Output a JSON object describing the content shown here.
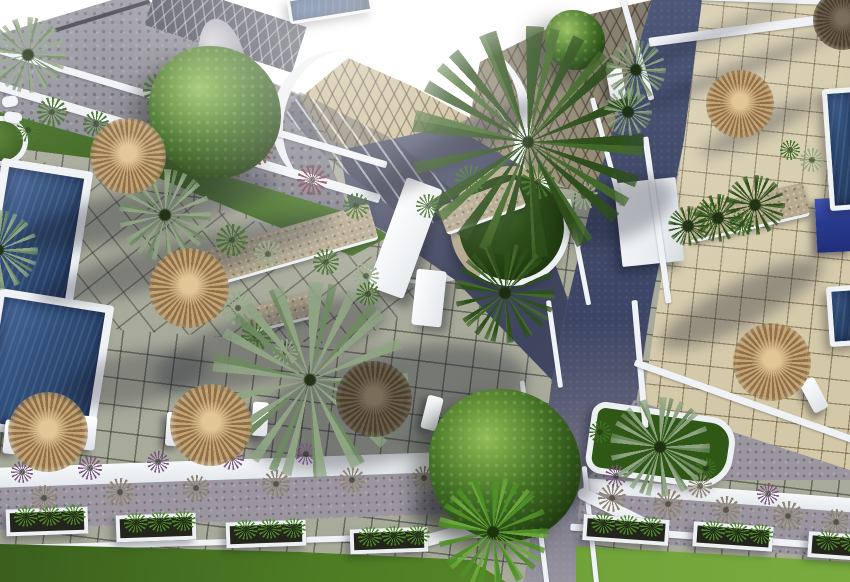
{
  "scene": {
    "description": "Aerial 3D architectural rendering of a resort courtyard: swimming pools and grey tiled terrace on the left, beige tiled terrace on the right, curved white walls and roofs at top, a navy pathway curving through the middle with a circular palm planter, thatched straw parasols with white sun loungers, landscaped beds, and a street with white-framed planters and lawns at the bottom",
    "palette": {
      "wall": "#f0f3f6",
      "tileL": "#a8aa9a",
      "groutL": "#62655c",
      "tileR": "#d3c8a7",
      "groutR": "#8b7a55",
      "road": "#434c6b",
      "cobble": "#75737f",
      "gravel": "#9b96a0",
      "lawnL": "#4e7c24",
      "lawnR": "#74a53c",
      "bedGreen": "#4a7423",
      "bedDark": "#2f5716",
      "water1": "#47689a",
      "water2": "#223a5e",
      "cube": "#2e3f96",
      "straw1": "#c6a471",
      "straw2": "#8d6f4a",
      "strawHi": "#e2c796",
      "canopy": "#3f6d2b",
      "silverPalm": "#8ea483",
      "brightPalm": "#5f9c2f",
      "stone": "#b4a88d",
      "tanRoof": "#c9b88e",
      "shadow": "#181b2a"
    },
    "pools": [
      {
        "x": -10,
        "y": 164,
        "w": 92,
        "h": 152,
        "rot": 9,
        "b": 8
      },
      {
        "x": -14,
        "y": 296,
        "w": 118,
        "h": 142,
        "rot": 9,
        "b": 8
      },
      {
        "x": 826,
        "y": 88,
        "w": 34,
        "h": 122,
        "rot": -4,
        "b": 5
      },
      {
        "x": 828,
        "y": 286,
        "w": 30,
        "h": 60,
        "rot": -4,
        "b": 5
      },
      {
        "x": 288,
        "y": -8,
        "w": 84,
        "h": 26,
        "rot": -9,
        "b": 3
      }
    ],
    "umbrellas": [
      {
        "x": 128,
        "y": 156,
        "r": 38,
        "tone": "light"
      },
      {
        "x": 189,
        "y": 288,
        "r": 40,
        "tone": "light"
      },
      {
        "x": 48,
        "y": 432,
        "r": 40,
        "tone": "light"
      },
      {
        "x": 211,
        "y": 425,
        "r": 41,
        "tone": "light"
      },
      {
        "x": 374,
        "y": 399,
        "r": 38,
        "tone": "dark"
      },
      {
        "x": 740,
        "y": 104,
        "r": 34,
        "tone": "light"
      },
      {
        "x": 772,
        "y": 362,
        "r": 39,
        "tone": "light"
      },
      {
        "x": 843,
        "y": 20,
        "r": 30,
        "tone": "dark"
      }
    ],
    "loungers": [
      {
        "x": 4,
        "y": 420,
        "rot": 6
      },
      {
        "x": 80,
        "y": 416,
        "rot": 6
      },
      {
        "x": 166,
        "y": 412,
        "rot": 4
      },
      {
        "x": 252,
        "y": 402,
        "rot": 4
      },
      {
        "x": 424,
        "y": 396,
        "rot": 14
      },
      {
        "x": 806,
        "y": 378,
        "rot": -28
      },
      {
        "x": 608,
        "y": 66,
        "rot": -10
      }
    ],
    "palms": [
      {
        "x": 528,
        "y": 142,
        "r": 116,
        "v": "dark"
      },
      {
        "x": 310,
        "y": 380,
        "r": 98,
        "v": "silver"
      },
      {
        "x": 493,
        "y": 532,
        "r": 55,
        "v": "bright"
      },
      {
        "x": 660,
        "y": 447,
        "r": 50,
        "v": "silver"
      },
      {
        "x": 505,
        "y": 293,
        "r": 50,
        "v": "dark"
      },
      {
        "x": 165,
        "y": 215,
        "r": 46,
        "v": "silver"
      },
      {
        "x": -2,
        "y": 250,
        "r": 40,
        "v": "silver"
      },
      {
        "x": 28,
        "y": 55,
        "r": 38,
        "v": "silver"
      },
      {
        "x": 755,
        "y": 205,
        "r": 30,
        "v": "dark"
      },
      {
        "x": 718,
        "y": 218,
        "r": 24,
        "v": "dark"
      },
      {
        "x": 688,
        "y": 226,
        "r": 20,
        "v": "dark"
      },
      {
        "x": 636,
        "y": 70,
        "r": 30,
        "v": "silver"
      },
      {
        "x": 628,
        "y": 112,
        "r": 24,
        "v": "silver"
      }
    ],
    "trees": [
      {
        "x": 215,
        "y": 112,
        "r": 66
      },
      {
        "x": 505,
        "y": 465,
        "r": 76
      },
      {
        "x": 575,
        "y": 40,
        "r": 30
      }
    ],
    "stonebeds": [
      {
        "x": 205,
        "y": 226,
        "w": 172,
        "h": 38,
        "rot": -16
      },
      {
        "x": 440,
        "y": 192,
        "w": 84,
        "h": 30,
        "rot": -20
      },
      {
        "x": 686,
        "y": 196,
        "w": 122,
        "h": 34,
        "rot": -13
      },
      {
        "x": 246,
        "y": 300,
        "w": 70,
        "h": 26,
        "rot": -14
      }
    ],
    "planters": [
      {
        "x": 6,
        "y": 508,
        "w": 82,
        "h": 27,
        "rot": -2
      },
      {
        "x": 116,
        "y": 514,
        "w": 80,
        "h": 27,
        "rot": -2
      },
      {
        "x": 226,
        "y": 521,
        "w": 80,
        "h": 26,
        "rot": -2
      },
      {
        "x": 350,
        "y": 528,
        "w": 78,
        "h": 25,
        "rot": -2
      },
      {
        "x": 583,
        "y": 517,
        "w": 86,
        "h": 26,
        "rot": 4
      },
      {
        "x": 693,
        "y": 524,
        "w": 80,
        "h": 25,
        "rot": 4
      },
      {
        "x": 808,
        "y": 533,
        "w": 56,
        "h": 26,
        "rot": 4
      }
    ],
    "curbs": [
      {
        "x": -10,
        "y": 104,
        "w": 405,
        "h": 7,
        "rot": 16.5
      },
      {
        "x": -10,
        "y": 138,
        "w": 398,
        "h": 9,
        "rot": 16.5
      },
      {
        "x": 648,
        "y": 24,
        "w": 212,
        "h": 9,
        "rot": -7.5
      },
      {
        "x": 700,
        "y": -3,
        "w": 152,
        "h": 6,
        "rot": 2
      },
      {
        "x": 654,
        "y": 136,
        "w": 6,
        "h": 168,
        "rot": -8
      },
      {
        "x": 637,
        "y": 300,
        "w": 6,
        "h": 128,
        "rot": -5
      },
      {
        "x": 634,
        "y": -4,
        "w": 6,
        "h": 106,
        "rot": -16
      },
      {
        "x": 604,
        "y": 96,
        "w": 5,
        "h": 110,
        "rot": -15
      },
      {
        "x": 576,
        "y": 198,
        "w": 5,
        "h": 108,
        "rot": -11
      },
      {
        "x": 552,
        "y": 300,
        "w": 5,
        "h": 88,
        "rot": -8
      },
      {
        "x": 532,
        "y": 380,
        "w": 5,
        "h": 206,
        "rot": -7
      },
      {
        "x": 588,
        "y": 466,
        "w": 5,
        "h": 120,
        "rot": -6
      },
      {
        "x": 628,
        "y": 398,
        "w": 234,
        "h": 7,
        "rot": 19.5
      },
      {
        "x": 398,
        "y": 524,
        "w": 132,
        "h": 12,
        "rot": -16,
        "r": 8
      },
      {
        "x": 574,
        "y": 504,
        "w": 84,
        "h": 12,
        "rot": 26,
        "r": 8
      },
      {
        "x": 2,
        "y": 96,
        "w": 16,
        "h": 11,
        "rot": -10,
        "r": 5
      },
      {
        "x": 4,
        "y": 112,
        "w": 18,
        "h": 11,
        "rot": 8,
        "r": 5
      },
      {
        "x": 52,
        "y": 14,
        "w": 100,
        "h": 4,
        "rot": -17,
        "dark": true
      }
    ],
    "shadows": [
      {
        "x": 0,
        "y": 190,
        "w": 280,
        "h": 46,
        "rot": -13,
        "o": 0.32
      },
      {
        "x": 30,
        "y": 238,
        "w": 310,
        "h": 42,
        "rot": -15,
        "o": 0.3
      },
      {
        "x": 150,
        "y": 310,
        "w": 240,
        "h": 70,
        "rot": -17,
        "o": 0.3
      },
      {
        "x": 240,
        "y": 352,
        "w": 290,
        "h": 110,
        "rot": -13,
        "o": 0.34
      },
      {
        "x": 60,
        "y": 352,
        "w": 150,
        "h": 52,
        "rot": -11,
        "o": 0.26
      },
      {
        "x": 610,
        "y": 34,
        "w": 190,
        "h": 9,
        "rot": -22,
        "o": 0.4
      },
      {
        "x": 624,
        "y": 66,
        "w": 220,
        "h": 11,
        "rot": -21,
        "o": 0.4
      },
      {
        "x": 652,
        "y": 282,
        "w": 180,
        "h": 44,
        "rot": -27,
        "o": 0.34
      },
      {
        "x": 694,
        "y": 116,
        "w": 130,
        "h": 22,
        "rot": -25,
        "o": 0.3
      },
      {
        "x": 352,
        "y": 132,
        "w": 200,
        "h": 34,
        "rot": -29,
        "o": 0.36
      },
      {
        "x": 408,
        "y": 472,
        "w": 190,
        "h": 54,
        "rot": -9,
        "o": 0.32
      },
      {
        "x": 556,
        "y": 180,
        "w": 120,
        "h": 60,
        "rot": -20,
        "o": 0.3
      }
    ],
    "tufts": [
      {
        "x": 52,
        "y": 112,
        "d": 30,
        "v": "green"
      },
      {
        "x": 96,
        "y": 124,
        "d": 26,
        "v": "green"
      },
      {
        "x": 160,
        "y": 90,
        "d": 34,
        "v": "green"
      },
      {
        "x": 205,
        "y": 122,
        "d": 30,
        "v": "green"
      },
      {
        "x": 28,
        "y": 130,
        "d": 24,
        "v": "green"
      },
      {
        "x": 258,
        "y": 150,
        "d": 30,
        "v": "red"
      },
      {
        "x": 312,
        "y": 180,
        "d": 30,
        "v": "red"
      },
      {
        "x": 356,
        "y": 206,
        "d": 26,
        "v": "green"
      },
      {
        "x": 232,
        "y": 240,
        "d": 32,
        "v": "green"
      },
      {
        "x": 268,
        "y": 254,
        "d": 28,
        "v": "silver"
      },
      {
        "x": 326,
        "y": 262,
        "d": 26,
        "v": "green"
      },
      {
        "x": 366,
        "y": 276,
        "d": 26,
        "v": "silver"
      },
      {
        "x": 238,
        "y": 308,
        "d": 34,
        "v": "silver"
      },
      {
        "x": 256,
        "y": 336,
        "d": 30,
        "v": "green"
      },
      {
        "x": 286,
        "y": 352,
        "d": 26,
        "v": "silver"
      },
      {
        "x": 194,
        "y": 262,
        "d": 24,
        "v": "green"
      },
      {
        "x": 470,
        "y": 180,
        "d": 30,
        "v": "green"
      },
      {
        "x": 538,
        "y": 182,
        "d": 34,
        "v": "green"
      },
      {
        "x": 584,
        "y": 196,
        "d": 28,
        "v": "silver"
      },
      {
        "x": 428,
        "y": 206,
        "d": 24,
        "v": "green"
      },
      {
        "x": 710,
        "y": 216,
        "d": 26,
        "v": "green"
      },
      {
        "x": 742,
        "y": 224,
        "d": 24,
        "v": "green"
      },
      {
        "x": 44,
        "y": 498,
        "d": 26,
        "v": "dry"
      },
      {
        "x": 120,
        "y": 492,
        "d": 28,
        "v": "dry"
      },
      {
        "x": 196,
        "y": 488,
        "d": 26,
        "v": "dry"
      },
      {
        "x": 276,
        "y": 484,
        "d": 28,
        "v": "dry"
      },
      {
        "x": 352,
        "y": 480,
        "d": 26,
        "v": "dry"
      },
      {
        "x": 424,
        "y": 478,
        "d": 24,
        "v": "dry"
      },
      {
        "x": 22,
        "y": 472,
        "d": 22,
        "v": "purple"
      },
      {
        "x": 90,
        "y": 468,
        "d": 24,
        "v": "purple"
      },
      {
        "x": 158,
        "y": 462,
        "d": 22,
        "v": "purple"
      },
      {
        "x": 232,
        "y": 458,
        "d": 24,
        "v": "purple"
      },
      {
        "x": 306,
        "y": 454,
        "d": 22,
        "v": "purple"
      },
      {
        "x": 612,
        "y": 498,
        "d": 28,
        "v": "dry"
      },
      {
        "x": 668,
        "y": 504,
        "d": 30,
        "v": "dry"
      },
      {
        "x": 726,
        "y": 510,
        "d": 28,
        "v": "dry"
      },
      {
        "x": 788,
        "y": 516,
        "d": 30,
        "v": "dry"
      },
      {
        "x": 836,
        "y": 522,
        "d": 26,
        "v": "dry"
      },
      {
        "x": 616,
        "y": 476,
        "d": 22,
        "v": "purple"
      },
      {
        "x": 700,
        "y": 486,
        "d": 24,
        "v": "dry"
      },
      {
        "x": 768,
        "y": 494,
        "d": 22,
        "v": "purple"
      },
      {
        "x": 600,
        "y": 432,
        "d": 22,
        "v": "green"
      },
      {
        "x": 706,
        "y": 468,
        "d": 20,
        "v": "green"
      },
      {
        "x": 812,
        "y": 160,
        "d": 24,
        "v": "silver"
      },
      {
        "x": 790,
        "y": 150,
        "d": 20,
        "v": "green"
      },
      {
        "x": 368,
        "y": 294,
        "d": 24,
        "v": "green"
      }
    ]
  }
}
